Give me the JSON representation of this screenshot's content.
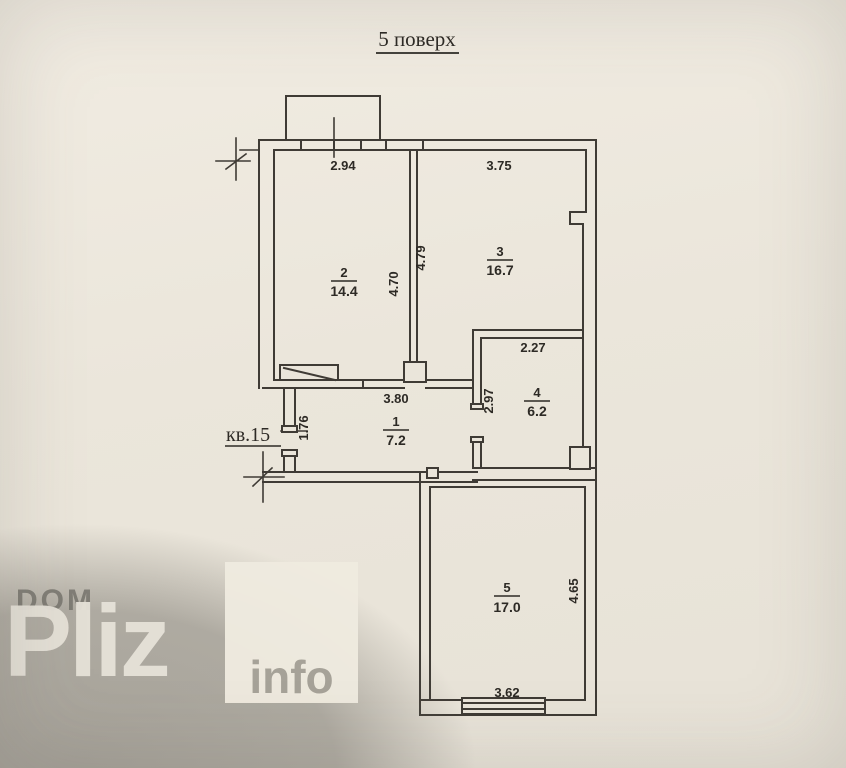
{
  "title": "5 поверх",
  "apartment": {
    "label": "кв.15"
  },
  "rooms": {
    "r1": {
      "number": "1",
      "area": "7.2"
    },
    "r2": {
      "number": "2",
      "area": "14.4"
    },
    "r3": {
      "number": "3",
      "area": "16.7"
    },
    "r4": {
      "number": "4",
      "area": "6.2"
    },
    "r5": {
      "number": "5",
      "area": "17.0"
    }
  },
  "dims": {
    "balcony_width": "2.94",
    "room3_top": "3.75",
    "room2_right_height": "4.70",
    "room3_left_height": "4.79",
    "hall_top": "3.80",
    "hall_left_height": "1.76",
    "room4_left_height": "2.97",
    "room4_top": "2.27",
    "room5_right_height": "4.65",
    "room5_bottom": "3.62"
  },
  "watermark": {
    "dom": "DOM",
    "pliz": "Pliz",
    "info": "info"
  },
  "colors": {
    "paper": "#eae5da",
    "ink": "#3f3b35",
    "shadow": "#64615a",
    "watermark_light": "#e6e2d8",
    "watermark_gray": "#76736c",
    "info_text": "#a6a298",
    "info_box": "#eee9df"
  }
}
